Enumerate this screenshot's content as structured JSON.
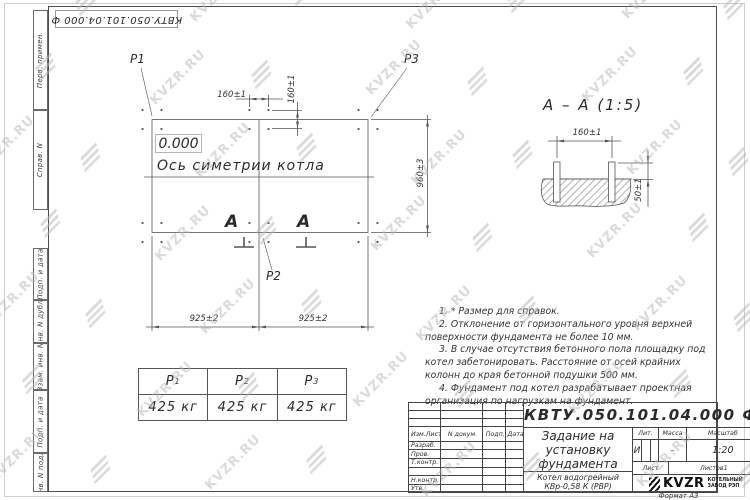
{
  "watermark": {
    "text": "KVZR.RU"
  },
  "sheet": {
    "format_note": "Формат А3"
  },
  "margins": {
    "top_stamp": "КВТУ.050.101.04.000  Ф",
    "left_labels": [
      "Перв. примен.",
      "Справ. N",
      "Подп. и дата",
      "Инв. N дубл.",
      "Взам. инв. N",
      "Подп. и дата",
      "Инв. N подл."
    ]
  },
  "plan": {
    "level_mark": "0.000",
    "symmetry_axis_label": "Ось симетрии котла",
    "section_letter": "A",
    "labels": {
      "p1": "P1",
      "p2": "P2",
      "p3": "P3"
    },
    "dims": {
      "anchor_spacing_h": "160±1",
      "anchor_spacing_v": "160±1",
      "frame_width": "960±3",
      "span_left": "925±2",
      "span_right": "925±2"
    }
  },
  "section_view": {
    "title": "A – A (1:5)",
    "dims": {
      "anchor_spacing": "160±1",
      "bolt_protrusion": "50±1"
    }
  },
  "loads_table": {
    "columns": [
      {
        "name": "P",
        "sub": "1",
        "value": "425 кг"
      },
      {
        "name": "P",
        "sub": "2",
        "value": "425 кг"
      },
      {
        "name": "P",
        "sub": "3",
        "value": "425 кг"
      }
    ]
  },
  "notes": [
    "1. * Размер для справок.",
    "2. Отклонение от горизонтального уровня верхней поверхности фундамента не более 10 мм.",
    "3. В случае отсутствия бетонного пола площадку под котел забетонировать. Расстояние от осей крайних колонн до края бетонной подушки 500 мм.",
    "4. Фундамент под котел разрабатывает проектная организация по нагрузкам на фундамент."
  ],
  "title_block": {
    "designation": "КВТУ.050.101.04.000  Ф",
    "document_name": "Задание на установку фундамента",
    "product": "Котел водогрейный КВр-0,58 К (РВР)",
    "table_header": [
      "Изм.Лист",
      "N докум.",
      "Подп.",
      "Дата"
    ],
    "sign_rows": [
      "Разраб.",
      "Пров.",
      "Т.контр.",
      "",
      "Н.контр.",
      "Утв."
    ],
    "lit": {
      "label": "Лит.",
      "value": "И"
    },
    "mass": {
      "label": "Масса",
      "value": "–"
    },
    "scale": {
      "label": "Масштаб",
      "value": "1:20"
    },
    "sheet": {
      "label": "Лист"
    },
    "sheets": {
      "label": "Листов",
      "value": "1"
    },
    "company": {
      "abbr": "KVZR",
      "line1": "КОТЕЛЬНЫЙ",
      "line2": "ЗАВОД РЭП"
    }
  }
}
